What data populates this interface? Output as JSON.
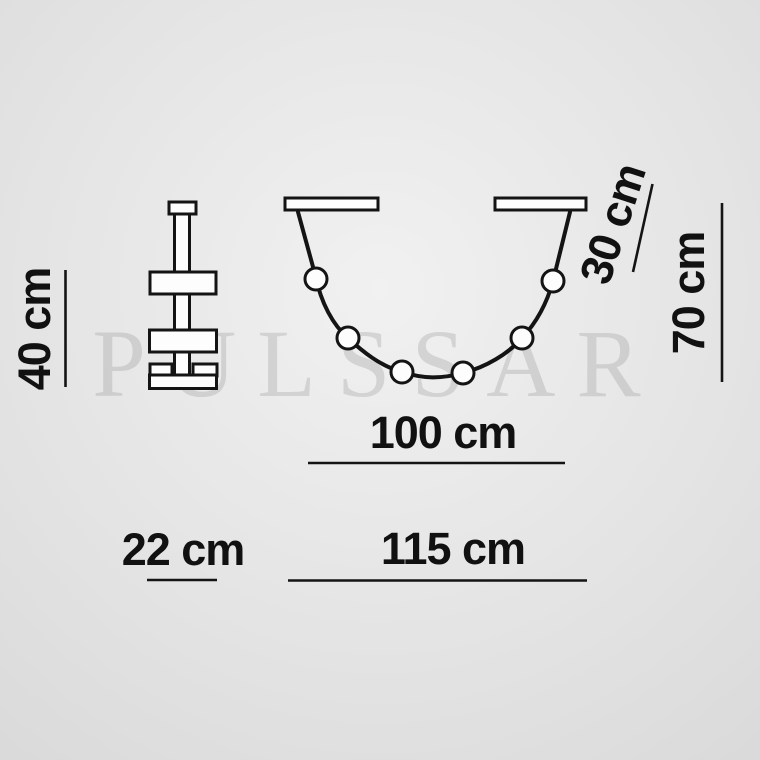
{
  "watermark": "PULSSAR",
  "diagram": {
    "type": "product-dimension-drawing",
    "views": {
      "side_view": "stacked pendant fixture side profile",
      "front_view": "two ceiling canopies with draped cable holding 6 sphere bulbs"
    },
    "bulb_count": 6
  },
  "labels": {
    "side_height": "40 cm",
    "side_width": "22 cm",
    "canopy_drop": "30 cm",
    "total_height": "70 cm",
    "inner_width": "100 cm",
    "total_width": "115 cm"
  },
  "colors": {
    "line": "#141414",
    "fill": "#fdfdfd",
    "text": "#111111",
    "watermark": "rgba(120,120,120,0.22)",
    "bg_center": "#f1f1f1",
    "bg_mid": "#e4e4e4",
    "bg_edge": "#d6d6d6"
  }
}
